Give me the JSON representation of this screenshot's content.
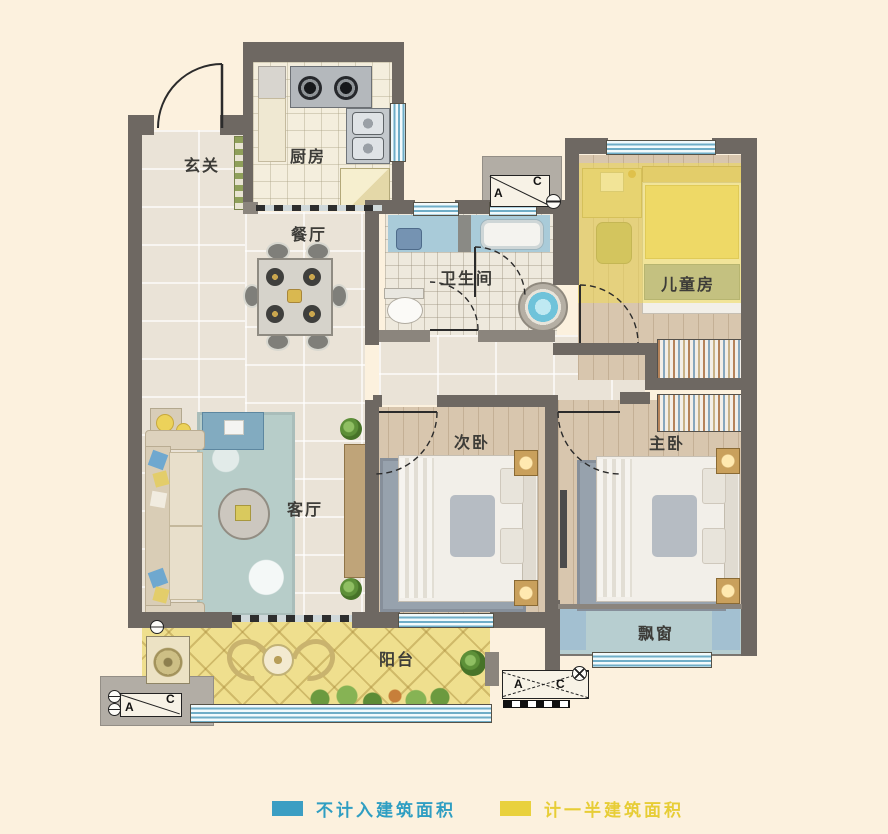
{
  "rooms": {
    "entry": "玄关",
    "kitchen": "厨房",
    "dining": "餐厅",
    "bathroom": "卫生间",
    "kids": "儿童房",
    "second_bedroom": "次卧",
    "master_bedroom": "主卧",
    "living": "客厅",
    "balcony": "阳台",
    "bay_window": "飘窗"
  },
  "legend": {
    "items": [
      {
        "label": "不计入建筑面积",
        "color": "#3b9ec3"
      },
      {
        "label": "计一半建筑面积",
        "color": "#e9d13d"
      }
    ]
  },
  "markers": {
    "top": {
      "a": "A",
      "c": "C"
    },
    "bottom_left": {
      "a": "A",
      "c": "C"
    },
    "bottom_middle": {
      "a": "A",
      "c": "C"
    }
  },
  "colors": {
    "background": "#fcf1de",
    "wall_dark": "#6e6862",
    "legend_blue": "#3b9ec3",
    "legend_yellow": "#e9d13d",
    "balcony_yellow": "#efdf8e",
    "bathroom_blue": "#a9cbd9",
    "bay_window_blue": "#b7ced0",
    "half_area_overlay": "#f0da54"
  }
}
